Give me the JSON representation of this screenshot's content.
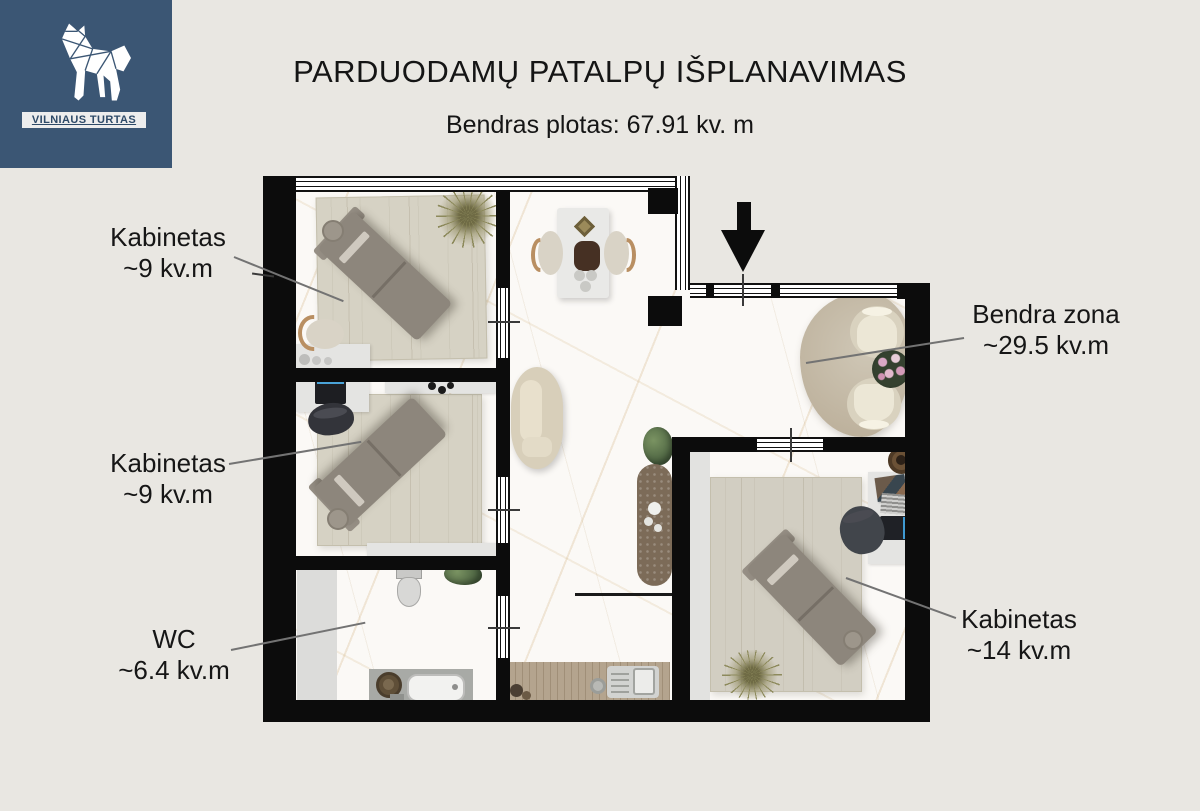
{
  "header": {
    "title": "PARDUODAMŲ PATALPŲ IŠPLANAVIMAS",
    "subtitle": "Bendras plotas: 67.91 kv. m"
  },
  "logo": {
    "brand": "VILNIAUS TURTAS"
  },
  "colors": {
    "background": "#e9e7e2",
    "logo_background": "#3b5674",
    "wall": "#0c0c0c",
    "rug": "#d6d2c4",
    "accent_blue": "#3f9ad2"
  },
  "rooms": {
    "kabinetas_top": {
      "name": "Kabinetas",
      "area": "~9 kv.m"
    },
    "kabinetas_mid": {
      "name": "Kabinetas",
      "area": "~9 kv.m"
    },
    "wc": {
      "name": "WC",
      "area": "~6.4 kv.m"
    },
    "bendra_zona": {
      "name": "Bendra zona",
      "area": "~29.5 kv.m"
    },
    "kabinetas_large": {
      "name": "Kabinetas",
      "area": "~14 kv.m"
    }
  }
}
